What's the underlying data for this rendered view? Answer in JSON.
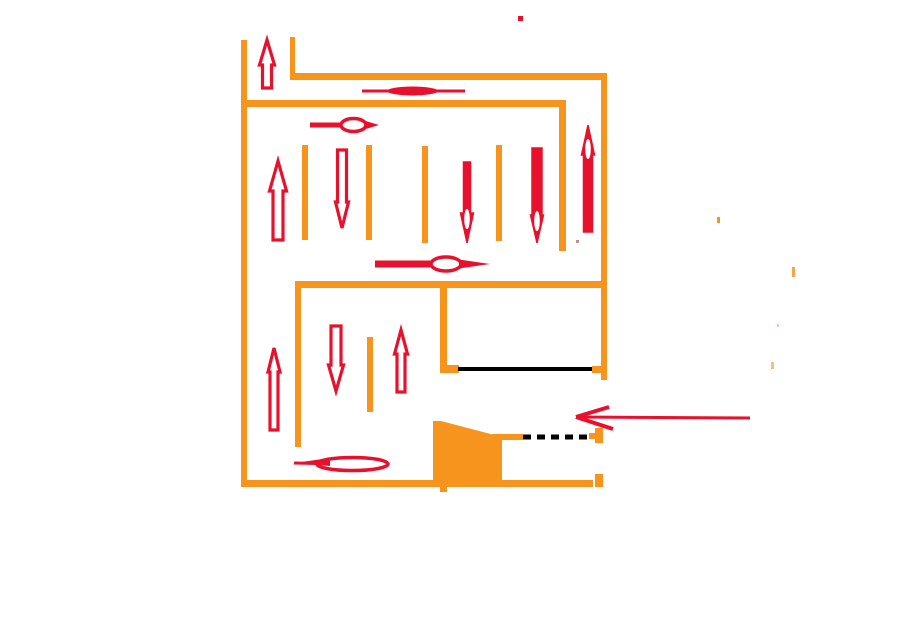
{
  "canvas": {
    "width": 914,
    "height": 639,
    "background": "#FFFFFF"
  },
  "colors": {
    "wall_orange": "#F7941D",
    "arrow_red": "#E8112D",
    "line_black": "#000000",
    "white": "#FFFFFF"
  },
  "diagram": {
    "kind": "hand-drawn parking garage floor plan with traffic flow arrows",
    "walls": [
      {
        "name": "left-outer-wall",
        "x": 241,
        "y": 40,
        "w": 6,
        "h": 446
      },
      {
        "name": "top-entry-wall",
        "x": 290,
        "y": 37,
        "w": 5,
        "h": 40
      },
      {
        "name": "top-outer-wall",
        "x": 290,
        "y": 73,
        "w": 317,
        "h": 7
      },
      {
        "name": "right-outer-wall",
        "x": 601,
        "y": 73,
        "w": 6,
        "h": 307
      },
      {
        "name": "upper-inner-wall",
        "x": 242,
        "y": 100,
        "w": 324,
        "h": 7
      },
      {
        "name": "inner-corner-wall",
        "x": 559,
        "y": 100,
        "w": 7,
        "h": 151
      },
      {
        "name": "middle-wall",
        "x": 295,
        "y": 281,
        "w": 312,
        "h": 7
      },
      {
        "name": "left-column-wall",
        "x": 295,
        "y": 281,
        "w": 6,
        "h": 166
      },
      {
        "name": "room-left-wall",
        "x": 440,
        "y": 283,
        "w": 7,
        "h": 89
      },
      {
        "name": "room-left-stub",
        "x": 440,
        "y": 365,
        "w": 19,
        "h": 8
      },
      {
        "name": "room-right-stub",
        "x": 592,
        "y": 366,
        "w": 10,
        "h": 7
      },
      {
        "name": "gate-post",
        "x": 595,
        "y": 428,
        "w": 8,
        "h": 15
      },
      {
        "name": "gate-post-tab",
        "x": 589,
        "y": 433,
        "w": 7,
        "h": 6
      },
      {
        "name": "ramp-ledge",
        "x": 492,
        "y": 434,
        "w": 31,
        "h": 6
      },
      {
        "name": "bottom-wall",
        "x": 241,
        "y": 480,
        "w": 352,
        "h": 7
      },
      {
        "name": "bottom-right-corner",
        "x": 595,
        "y": 474,
        "w": 8,
        "h": 13
      },
      {
        "name": "bottom-stub",
        "x": 440,
        "y": 486,
        "w": 7,
        "h": 6
      }
    ],
    "dividers": [
      {
        "name": "parking-divider",
        "x": 302,
        "y": 145,
        "w": 6,
        "h": 95
      },
      {
        "name": "parking-divider",
        "x": 366,
        "y": 145,
        "w": 6,
        "h": 95
      },
      {
        "name": "parking-divider",
        "x": 422,
        "y": 146,
        "w": 6,
        "h": 97
      },
      {
        "name": "parking-divider",
        "x": 496,
        "y": 145,
        "w": 6,
        "h": 96
      },
      {
        "name": "parking-divider",
        "x": 367,
        "y": 337,
        "w": 6,
        "h": 75
      }
    ],
    "ramp": {
      "name": "ramp-wedge",
      "points": "433,421 441,421 502,437 502,486 433,486"
    },
    "black_lines": [
      {
        "name": "door-line",
        "x1": 458,
        "y1": 369,
        "x2": 592,
        "y2": 369,
        "width": 4,
        "dash": ""
      },
      {
        "name": "gate-dashed-line",
        "x1": 523,
        "y1": 437,
        "x2": 592,
        "y2": 437,
        "width": 5,
        "dash": "8 6"
      }
    ],
    "v_arrows": [
      {
        "name": "flow-arrow-up",
        "cx": 267,
        "top": 40,
        "bottom": 88,
        "dir": "up",
        "style": "outline",
        "shaft": 9,
        "head": 15,
        "headlen": 25
      },
      {
        "name": "flow-arrow-up",
        "cx": 278,
        "top": 161,
        "bottom": 240,
        "dir": "up",
        "style": "outline",
        "shaft": 10,
        "head": 17,
        "headlen": 30
      },
      {
        "name": "flow-arrow-down",
        "cx": 342,
        "top": 150,
        "bottom": 228,
        "dir": "down",
        "style": "outline",
        "shaft": 9,
        "head": 13,
        "headlen": 26
      },
      {
        "name": "flow-arrow-down",
        "cx": 467,
        "top": 162,
        "bottom": 243,
        "dir": "down",
        "style": "filled",
        "shaft": 7,
        "head": 13,
        "headlen": 30
      },
      {
        "name": "flow-arrow-down",
        "cx": 537,
        "top": 148,
        "bottom": 243,
        "dir": "down",
        "style": "filled",
        "shaft": 10,
        "head": 13,
        "headlen": 28
      },
      {
        "name": "flow-arrow-up",
        "cx": 588,
        "top": 125,
        "bottom": 232,
        "dir": "up",
        "style": "filled",
        "shaft": 9,
        "head": 13,
        "headlen": 30
      },
      {
        "name": "flow-arrow-up",
        "cx": 274,
        "top": 348,
        "bottom": 430,
        "dir": "up",
        "style": "outline",
        "shaft": 8,
        "head": 12,
        "headlen": 24
      },
      {
        "name": "flow-arrow-down",
        "cx": 336,
        "top": 326,
        "bottom": 391,
        "dir": "down",
        "style": "outline",
        "shaft": 10,
        "head": 15,
        "headlen": 26
      },
      {
        "name": "flow-arrow-up",
        "cx": 401,
        "top": 330,
        "bottom": 392,
        "dir": "up",
        "style": "outline",
        "shaft": 8,
        "head": 13,
        "headlen": 24
      }
    ],
    "h_arrows": [
      {
        "name": "flow-arrow-right-lens",
        "type": "lens",
        "y": 91,
        "x1": 362,
        "x2": 465,
        "lens_x1": 387,
        "lens_x2": 438,
        "line_w": 3,
        "lens_h": 9
      },
      {
        "name": "flow-arrow-right",
        "type": "ring-right",
        "y": 125,
        "tail": 310,
        "ring_x1": 341,
        "ring_x2": 366,
        "tip": 379,
        "shaft_w": 5,
        "ring_h": 13
      },
      {
        "name": "flow-arrow-right",
        "type": "ring-right",
        "y": 264,
        "tail": 375,
        "ring_x1": 431,
        "ring_x2": 461,
        "tip": 490,
        "shaft_w": 7,
        "ring_h": 14
      },
      {
        "name": "flow-arrow-left",
        "type": "ring-left",
        "y": 463,
        "tip": 294,
        "ring_x1": 317,
        "ring_x2": 388,
        "tail": 388,
        "shaft_w": 3,
        "ring_h": 13
      },
      {
        "name": "entrance-arrow-left",
        "type": "barb-left",
        "y": 417,
        "tip_x": 576,
        "tail_x": 750,
        "barb1": [
          609,
          407
        ],
        "barb2": [
          613,
          429
        ],
        "line_w": 3,
        "barb_w": 4
      }
    ],
    "marks": [
      {
        "name": "stray-red-dot",
        "x": 518,
        "y": 16,
        "w": 5,
        "h": 5,
        "color": "#E8112D"
      },
      {
        "name": "stray-red-dash",
        "x": 539,
        "y": 193,
        "w": 3,
        "h": 6,
        "color": "#E8112D"
      },
      {
        "name": "stray-gray-dot",
        "x": 576,
        "y": 240,
        "w": 3,
        "h": 3,
        "color": "#B89090"
      },
      {
        "name": "stray-orange-tick",
        "x": 717,
        "y": 217,
        "w": 3,
        "h": 6,
        "color": "#F7941D"
      },
      {
        "name": "stray-orange-tick",
        "x": 792,
        "y": 267,
        "w": 3,
        "h": 10,
        "color": "#F9A44A"
      },
      {
        "name": "stray-pink-dot",
        "x": 777,
        "y": 324,
        "w": 2,
        "h": 3,
        "color": "#F4C2C2"
      },
      {
        "name": "stray-orange-tick",
        "x": 771,
        "y": 362,
        "w": 3,
        "h": 7,
        "color": "#FBBF7E"
      }
    ]
  }
}
